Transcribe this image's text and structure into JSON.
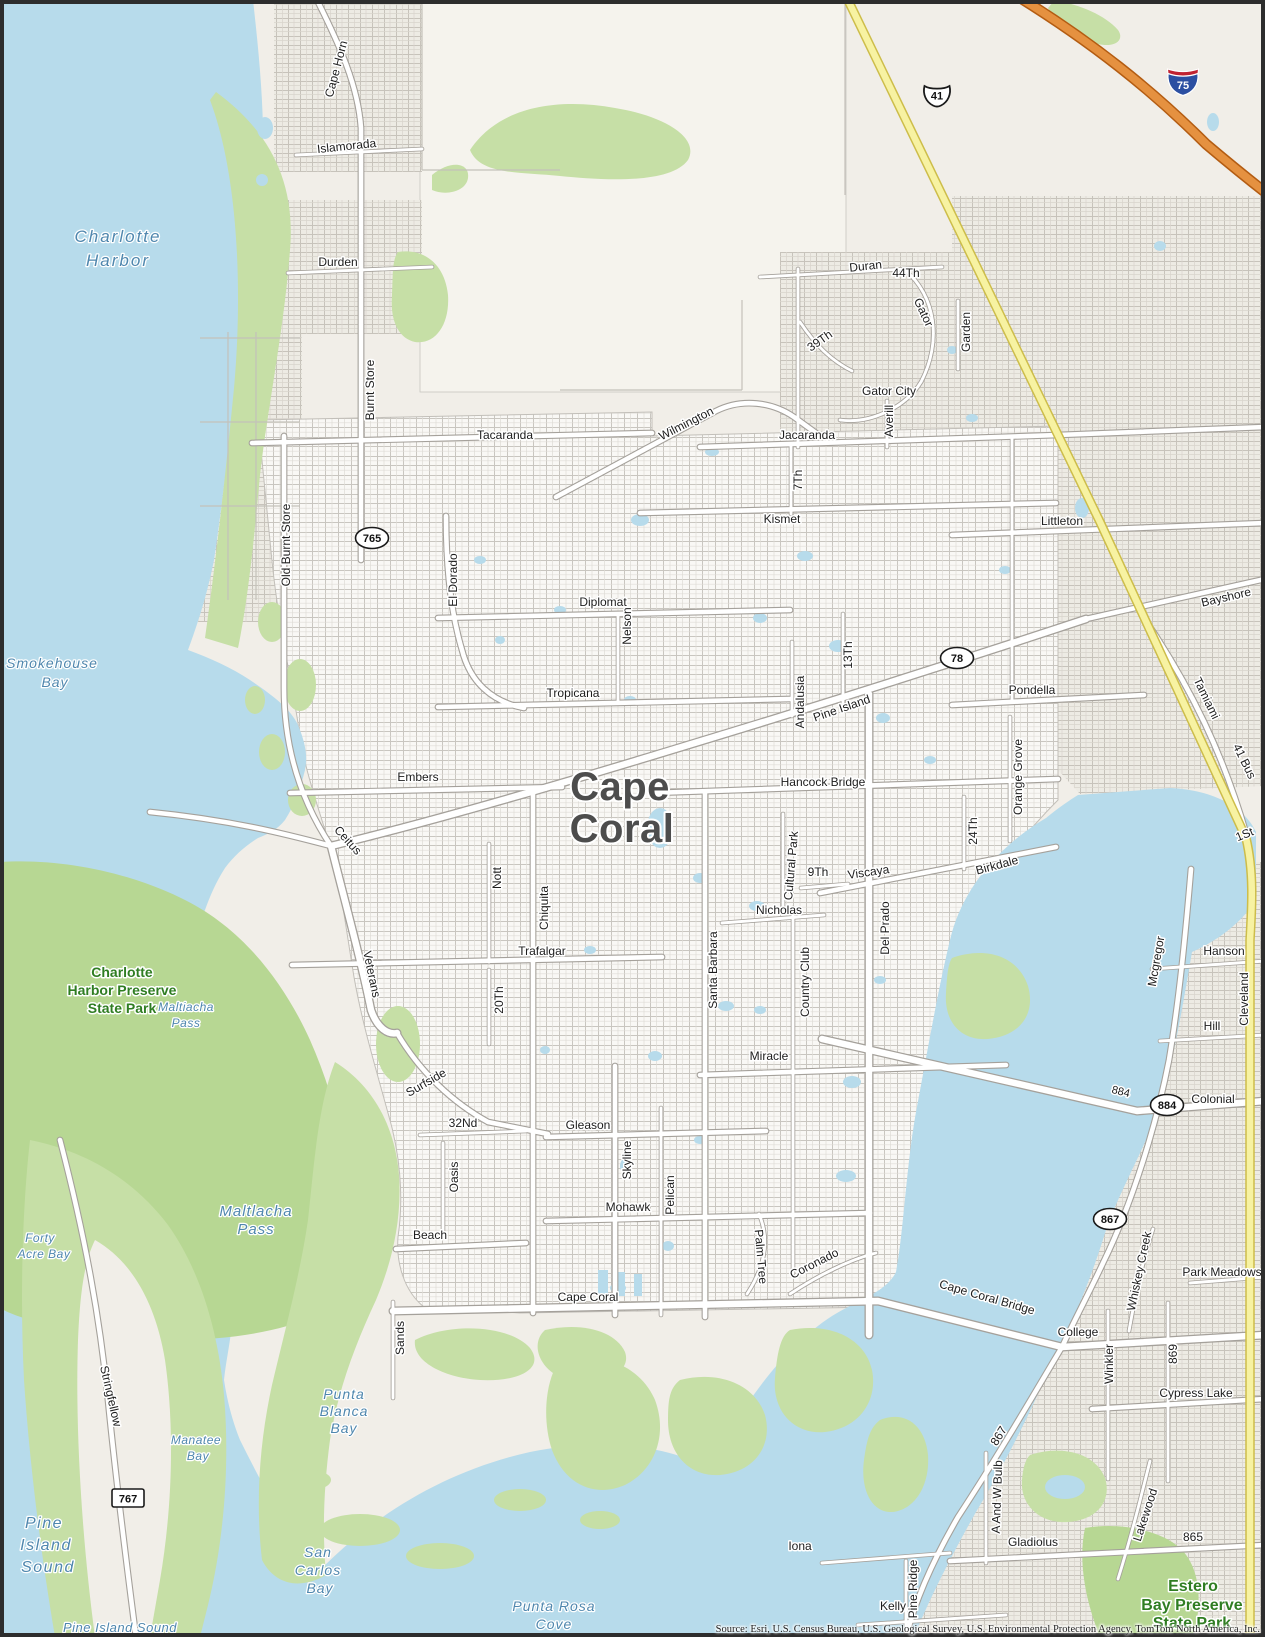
{
  "map": {
    "attribution": "Source: Esri, U.S. Census Bureau, U.S. Geological Survey, U.S. Environmental Protection Agency, TomTom North America, Inc.",
    "colors": {
      "land": "#f1eee8",
      "urban": "#edebe4",
      "water": "#b7dbeb",
      "vegetation": "#c6dfa6",
      "vegetation_dark": "#b7d793",
      "road_fill": "#ffffff",
      "road_casing": "#a5a19b",
      "highway_yellow": "#f7f2a2",
      "highway_yellow_casing": "#cdbd4a",
      "interstate_orange": "#e59140",
      "interstate_casing": "#b35c12",
      "water_label": "#4f87ae",
      "park_label": "#2f7d22",
      "city_label": "#4d4d4d"
    }
  },
  "labels": {
    "city": [
      {
        "t": "Cape",
        "x": 620,
        "y": 800,
        "r": 0,
        "s": 40
      },
      {
        "t": "Coral",
        "x": 622,
        "y": 842,
        "r": 0,
        "s": 40
      }
    ],
    "road": [
      {
        "t": "Cape Horn",
        "x": 340,
        "y": 70,
        "r": -75,
        "s": 12
      },
      {
        "t": "Islamorada",
        "x": 347,
        "y": 150,
        "r": -6,
        "s": 12
      },
      {
        "t": "Durden",
        "x": 338,
        "y": 266,
        "r": 0,
        "s": 12
      },
      {
        "t": "Duran",
        "x": 866,
        "y": 270,
        "r": -6,
        "s": 12
      },
      {
        "t": "44Th",
        "x": 906,
        "y": 277,
        "r": 0,
        "s": 12
      },
      {
        "t": "Gator",
        "x": 920,
        "y": 314,
        "r": 65,
        "s": 12
      },
      {
        "t": "Garden",
        "x": 970,
        "y": 332,
        "r": -90,
        "s": 12
      },
      {
        "t": "39Th",
        "x": 822,
        "y": 344,
        "r": -35,
        "s": 12
      },
      {
        "t": "Gator City",
        "x": 889,
        "y": 395,
        "r": 0,
        "s": 12
      },
      {
        "t": "Averill",
        "x": 893,
        "y": 421,
        "r": -90,
        "s": 12
      },
      {
        "t": "Burnt Store",
        "x": 374,
        "y": 390,
        "r": -90,
        "s": 12
      },
      {
        "t": "Old Burnt Store",
        "x": 290,
        "y": 545,
        "r": -90,
        "s": 12
      },
      {
        "t": "Tacaranda",
        "x": 505,
        "y": 439,
        "r": 0,
        "s": 12
      },
      {
        "t": "Wilmington",
        "x": 688,
        "y": 427,
        "r": -27,
        "s": 12
      },
      {
        "t": "Jacaranda",
        "x": 807,
        "y": 439,
        "r": 0,
        "s": 12
      },
      {
        "t": "7Th",
        "x": 802,
        "y": 480,
        "r": -90,
        "s": 12
      },
      {
        "t": "Kismet",
        "x": 782,
        "y": 523,
        "r": 0,
        "s": 12
      },
      {
        "t": "Littleton",
        "x": 1062,
        "y": 525,
        "r": 0,
        "s": 12
      },
      {
        "t": "Bayshore",
        "x": 1227,
        "y": 601,
        "r": -13,
        "s": 12
      },
      {
        "t": "El Dorado",
        "x": 457,
        "y": 580,
        "r": -90,
        "s": 12
      },
      {
        "t": "Diplomat",
        "x": 603,
        "y": 606,
        "r": 0,
        "s": 12
      },
      {
        "t": "Nelson",
        "x": 631,
        "y": 626,
        "r": -90,
        "s": 12
      },
      {
        "t": "Tropicana",
        "x": 573,
        "y": 697,
        "r": 0,
        "s": 12
      },
      {
        "t": "13Th",
        "x": 852,
        "y": 655,
        "r": -90,
        "s": 12
      },
      {
        "t": "Pine Island",
        "x": 843,
        "y": 712,
        "r": -19,
        "s": 12
      },
      {
        "t": "Pondella",
        "x": 1032,
        "y": 694,
        "r": 0,
        "s": 12
      },
      {
        "t": "Andalusia",
        "x": 804,
        "y": 702,
        "r": -90,
        "s": 12
      },
      {
        "t": "Orange Grove",
        "x": 1022,
        "y": 777,
        "r": -90,
        "s": 12
      },
      {
        "t": "Embers",
        "x": 418,
        "y": 781,
        "r": 0,
        "s": 12
      },
      {
        "t": "Hancock Bridge",
        "x": 823,
        "y": 786,
        "r": 0,
        "s": 12
      },
      {
        "t": "Tamiami",
        "x": 1203,
        "y": 700,
        "r": 64,
        "s": 12
      },
      {
        "t": "41 Bus",
        "x": 1241,
        "y": 763,
        "r": 64,
        "s": 12
      },
      {
        "t": "1St",
        "x": 1246,
        "y": 838,
        "r": -22,
        "s": 12
      },
      {
        "t": "Ceitus",
        "x": 345,
        "y": 843,
        "r": 48,
        "s": 12
      },
      {
        "t": "24Th",
        "x": 977,
        "y": 831,
        "r": -90,
        "s": 12
      },
      {
        "t": "Birkdale",
        "x": 998,
        "y": 869,
        "r": -15,
        "s": 12
      },
      {
        "t": "Viscaya",
        "x": 869,
        "y": 876,
        "r": -8,
        "s": 12
      },
      {
        "t": "9Th",
        "x": 818,
        "y": 876,
        "r": 0,
        "s": 12
      },
      {
        "t": "Nott",
        "x": 501,
        "y": 878,
        "r": -90,
        "s": 12
      },
      {
        "t": "Chiquita",
        "x": 548,
        "y": 908,
        "r": -90,
        "s": 12
      },
      {
        "t": "Nicholas",
        "x": 779,
        "y": 914,
        "r": 0,
        "s": 12
      },
      {
        "t": "Del Prado",
        "x": 889,
        "y": 928,
        "r": -90,
        "s": 12
      },
      {
        "t": "Cultural Park",
        "x": 795,
        "y": 866,
        "r": -85,
        "s": 12
      },
      {
        "t": "Country Club",
        "x": 809,
        "y": 982,
        "r": -90,
        "s": 12
      },
      {
        "t": "Santa Barbara",
        "x": 717,
        "y": 970,
        "r": -90,
        "s": 12
      },
      {
        "t": "Trafalgar",
        "x": 542,
        "y": 955,
        "r": 0,
        "s": 12
      },
      {
        "t": "Veterans",
        "x": 368,
        "y": 975,
        "r": 78,
        "s": 12
      },
      {
        "t": "20Th",
        "x": 503,
        "y": 1000,
        "r": -90,
        "s": 12
      },
      {
        "t": "Mcgregor",
        "x": 1160,
        "y": 962,
        "r": -80,
        "s": 12
      },
      {
        "t": "Hanson",
        "x": 1224,
        "y": 955,
        "r": 0,
        "s": 12
      },
      {
        "t": "Cleveland",
        "x": 1248,
        "y": 999,
        "r": -90,
        "s": 12
      },
      {
        "t": "Hill",
        "x": 1212,
        "y": 1030,
        "r": 0,
        "s": 12
      },
      {
        "t": "Miracle",
        "x": 769,
        "y": 1060,
        "r": 0,
        "s": 12
      },
      {
        "t": "Surfside",
        "x": 428,
        "y": 1086,
        "r": -30,
        "s": 12
      },
      {
        "t": "884",
        "x": 1120,
        "y": 1095,
        "r": 14,
        "s": 11
      },
      {
        "t": "Colonial",
        "x": 1213,
        "y": 1103,
        "r": 0,
        "s": 12
      },
      {
        "t": "32Nd",
        "x": 463,
        "y": 1127,
        "r": 0,
        "s": 12
      },
      {
        "t": "Gleason",
        "x": 588,
        "y": 1129,
        "r": 0,
        "s": 12
      },
      {
        "t": "Skyline",
        "x": 631,
        "y": 1160,
        "r": -90,
        "s": 12
      },
      {
        "t": "Oasis",
        "x": 458,
        "y": 1177,
        "r": -90,
        "s": 12
      },
      {
        "t": "Pelican",
        "x": 674,
        "y": 1195,
        "r": -90,
        "s": 12
      },
      {
        "t": "Mohawk",
        "x": 628,
        "y": 1211,
        "r": 0,
        "s": 12
      },
      {
        "t": "Palm Tree",
        "x": 757,
        "y": 1257,
        "r": 85,
        "s": 12
      },
      {
        "t": "Beach",
        "x": 430,
        "y": 1239,
        "r": 0,
        "s": 12
      },
      {
        "t": "Coronado",
        "x": 816,
        "y": 1267,
        "r": -27,
        "s": 12
      },
      {
        "t": "Whiskey Creek",
        "x": 1143,
        "y": 1272,
        "r": -78,
        "s": 12
      },
      {
        "t": "Park Meadows",
        "x": 1222,
        "y": 1276,
        "r": 0,
        "s": 12
      },
      {
        "t": "Cape Coral Bridge",
        "x": 986,
        "y": 1301,
        "r": 16,
        "s": 12
      },
      {
        "t": "Cape Coral",
        "x": 588,
        "y": 1301,
        "r": 0,
        "s": 12
      },
      {
        "t": "College",
        "x": 1078,
        "y": 1336,
        "r": 0,
        "s": 12
      },
      {
        "t": "Sands",
        "x": 404,
        "y": 1338,
        "r": -90,
        "s": 12
      },
      {
        "t": "Winkler",
        "x": 1113,
        "y": 1364,
        "r": -90,
        "s": 12
      },
      {
        "t": "869",
        "x": 1177,
        "y": 1354,
        "r": -90,
        "s": 12
      },
      {
        "t": "Cypress Lake",
        "x": 1196,
        "y": 1397,
        "r": 0,
        "s": 12
      },
      {
        "t": "867",
        "x": 1002,
        "y": 1438,
        "r": -58,
        "s": 12
      },
      {
        "t": "Stringfellow",
        "x": 107,
        "y": 1397,
        "r": 77,
        "s": 12
      },
      {
        "t": "A And W Bulb",
        "x": 1001,
        "y": 1497,
        "r": -88,
        "s": 12
      },
      {
        "t": "Lakewood",
        "x": 1149,
        "y": 1516,
        "r": -72,
        "s": 12
      },
      {
        "t": "865",
        "x": 1193,
        "y": 1541,
        "r": 0,
        "s": 12
      },
      {
        "t": "Gladiolus",
        "x": 1033,
        "y": 1546,
        "r": 0,
        "s": 12
      },
      {
        "t": "Iona",
        "x": 800,
        "y": 1550,
        "r": 0,
        "s": 12
      },
      {
        "t": "Pine Ridge",
        "x": 917,
        "y": 1589,
        "r": -90,
        "s": 12
      },
      {
        "t": "Kelly",
        "x": 893,
        "y": 1610,
        "r": 0,
        "s": 12
      }
    ],
    "water": [
      {
        "t": "Charlotte",
        "x": 118,
        "y": 242,
        "r": 0,
        "s": 17,
        "ls": 2
      },
      {
        "t": "Harbor",
        "x": 118,
        "y": 266,
        "r": 0,
        "s": 17,
        "ls": 2
      },
      {
        "t": "Smokehouse",
        "x": 52,
        "y": 668,
        "r": 0,
        "s": 14,
        "ls": 1
      },
      {
        "t": "Bay",
        "x": 55,
        "y": 687,
        "r": 0,
        "s": 14,
        "ls": 1
      },
      {
        "t": "Maltiacha",
        "x": 186,
        "y": 1011,
        "r": 0,
        "s": 12,
        "ls": 0.5
      },
      {
        "t": "Pass",
        "x": 186,
        "y": 1027,
        "r": 0,
        "s": 12,
        "ls": 0.5
      },
      {
        "t": "Maltlacha",
        "x": 256,
        "y": 1216,
        "r": 0,
        "s": 15,
        "ls": 1
      },
      {
        "t": "Pass",
        "x": 256,
        "y": 1234,
        "r": 0,
        "s": 15,
        "ls": 1
      },
      {
        "t": "Forty",
        "x": 40,
        "y": 1242,
        "r": 0,
        "s": 12,
        "ls": 0.5
      },
      {
        "t": "Acre Bay",
        "x": 44,
        "y": 1258,
        "r": 0,
        "s": 12,
        "ls": 0.5
      },
      {
        "t": "Punta",
        "x": 344,
        "y": 1399,
        "r": 0,
        "s": 14,
        "ls": 1
      },
      {
        "t": "Blanca",
        "x": 344,
        "y": 1416,
        "r": 0,
        "s": 14,
        "ls": 1
      },
      {
        "t": "Bay",
        "x": 344,
        "y": 1433,
        "r": 0,
        "s": 14,
        "ls": 1
      },
      {
        "t": "Manatee",
        "x": 196,
        "y": 1444,
        "r": 0,
        "s": 12,
        "ls": 0.5
      },
      {
        "t": "Bay",
        "x": 198,
        "y": 1460,
        "r": 0,
        "s": 12,
        "ls": 0.5
      },
      {
        "t": "Pine",
        "x": 44,
        "y": 1528,
        "r": 0,
        "s": 16,
        "ls": 1.5
      },
      {
        "t": "Island",
        "x": 46,
        "y": 1550,
        "r": 0,
        "s": 16,
        "ls": 1.5
      },
      {
        "t": "Sound",
        "x": 48,
        "y": 1572,
        "r": 0,
        "s": 16,
        "ls": 1.5
      },
      {
        "t": "San",
        "x": 318,
        "y": 1557,
        "r": 0,
        "s": 14,
        "ls": 1
      },
      {
        "t": "Carlos",
        "x": 318,
        "y": 1575,
        "r": 0,
        "s": 14,
        "ls": 1
      },
      {
        "t": "Bay",
        "x": 320,
        "y": 1593,
        "r": 0,
        "s": 14,
        "ls": 1
      },
      {
        "t": "Punta Rosa",
        "x": 554,
        "y": 1611,
        "r": 0,
        "s": 14,
        "ls": 1
      },
      {
        "t": "Cove",
        "x": 554,
        "y": 1629,
        "r": 0,
        "s": 14,
        "ls": 1
      },
      {
        "t": "Pine Island Sound",
        "x": 120,
        "y": 1632,
        "r": 0,
        "s": 13,
        "ls": 0.5
      }
    ],
    "park": [
      {
        "t": "Charlotte",
        "x": 122,
        "y": 977,
        "r": 0,
        "s": 14
      },
      {
        "t": "Harbor Preserve",
        "x": 122,
        "y": 995,
        "r": 0,
        "s": 14
      },
      {
        "t": "State Park",
        "x": 122,
        "y": 1013,
        "r": 0,
        "s": 14
      },
      {
        "t": "Estero",
        "x": 1193,
        "y": 1591,
        "r": 0,
        "s": 16
      },
      {
        "t": "Bay Preserve",
        "x": 1192,
        "y": 1610,
        "r": 0,
        "s": 16
      },
      {
        "t": "State Park",
        "x": 1192,
        "y": 1628,
        "r": 0,
        "s": 16
      }
    ]
  },
  "shields": [
    {
      "type": "us",
      "num": "41",
      "x": 937,
      "y": 95
    },
    {
      "type": "interstate",
      "num": "75",
      "x": 1183,
      "y": 82
    },
    {
      "type": "oval",
      "num": "765",
      "x": 372,
      "y": 538
    },
    {
      "type": "oval",
      "num": "78",
      "x": 957,
      "y": 658
    },
    {
      "type": "oval",
      "num": "884",
      "x": 1167,
      "y": 1105
    },
    {
      "type": "oval",
      "num": "867",
      "x": 1110,
      "y": 1219
    },
    {
      "type": "rect",
      "num": "767",
      "x": 128,
      "y": 1498
    }
  ]
}
